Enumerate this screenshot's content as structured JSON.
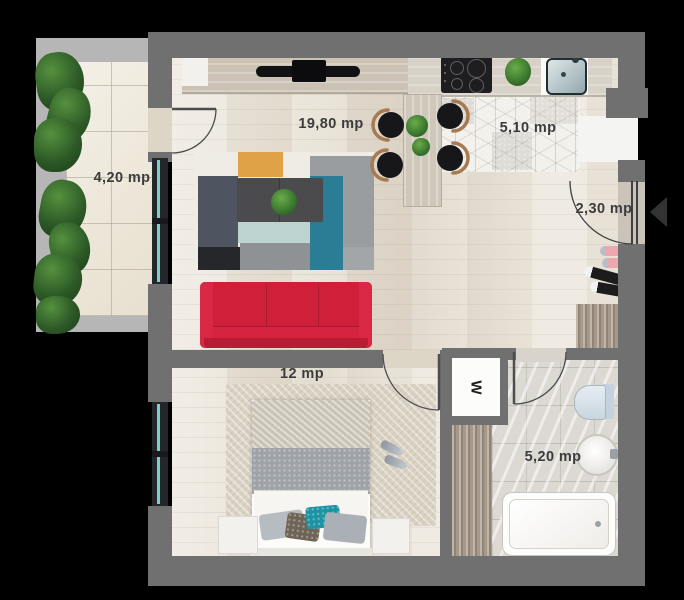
{
  "plan_title": "apartment-floor-plan",
  "rooms": {
    "balcony": {
      "label": "4,20 mp"
    },
    "living": {
      "label": "19,80 mp"
    },
    "kitchen": {
      "label": "5,10 mp"
    },
    "hall": {
      "label": "2,30 mp"
    },
    "bedroom": {
      "label": "12 mp"
    },
    "bathroom": {
      "label": "5,20 mp"
    }
  },
  "symbols": {
    "washer": "W",
    "entrance_arrow": "left-triangle"
  },
  "colors": {
    "background": "#000000",
    "wall": "#707070",
    "balcony_slab": "#b6b6b6",
    "wood_floor": "#e7e0d3",
    "balcony_tile": "#ebe4d3",
    "kitchen_hex_tile": "#f3f1ec",
    "bathroom_marble": "#dcd8d2",
    "sofa_red": "#ce2038",
    "rug_teal": "#2a7d94",
    "rug_orange": "#dfa246",
    "rug_slate": "#4e5560",
    "rug_mint": "#bcd3cf",
    "coffee_table": "#4b4b4d",
    "bed_blanket": "#9da3a9",
    "pillow_teal": "#1d93a4",
    "chair_seat": "#17171a",
    "chair_wood": "#a87a52",
    "plant_green": "#3c7a30",
    "window_glass": "#7fd0c4",
    "shoe_pink": "#eda7ae",
    "shoe_blue": "#3a74d8",
    "label_text": "#3c3c3c"
  }
}
